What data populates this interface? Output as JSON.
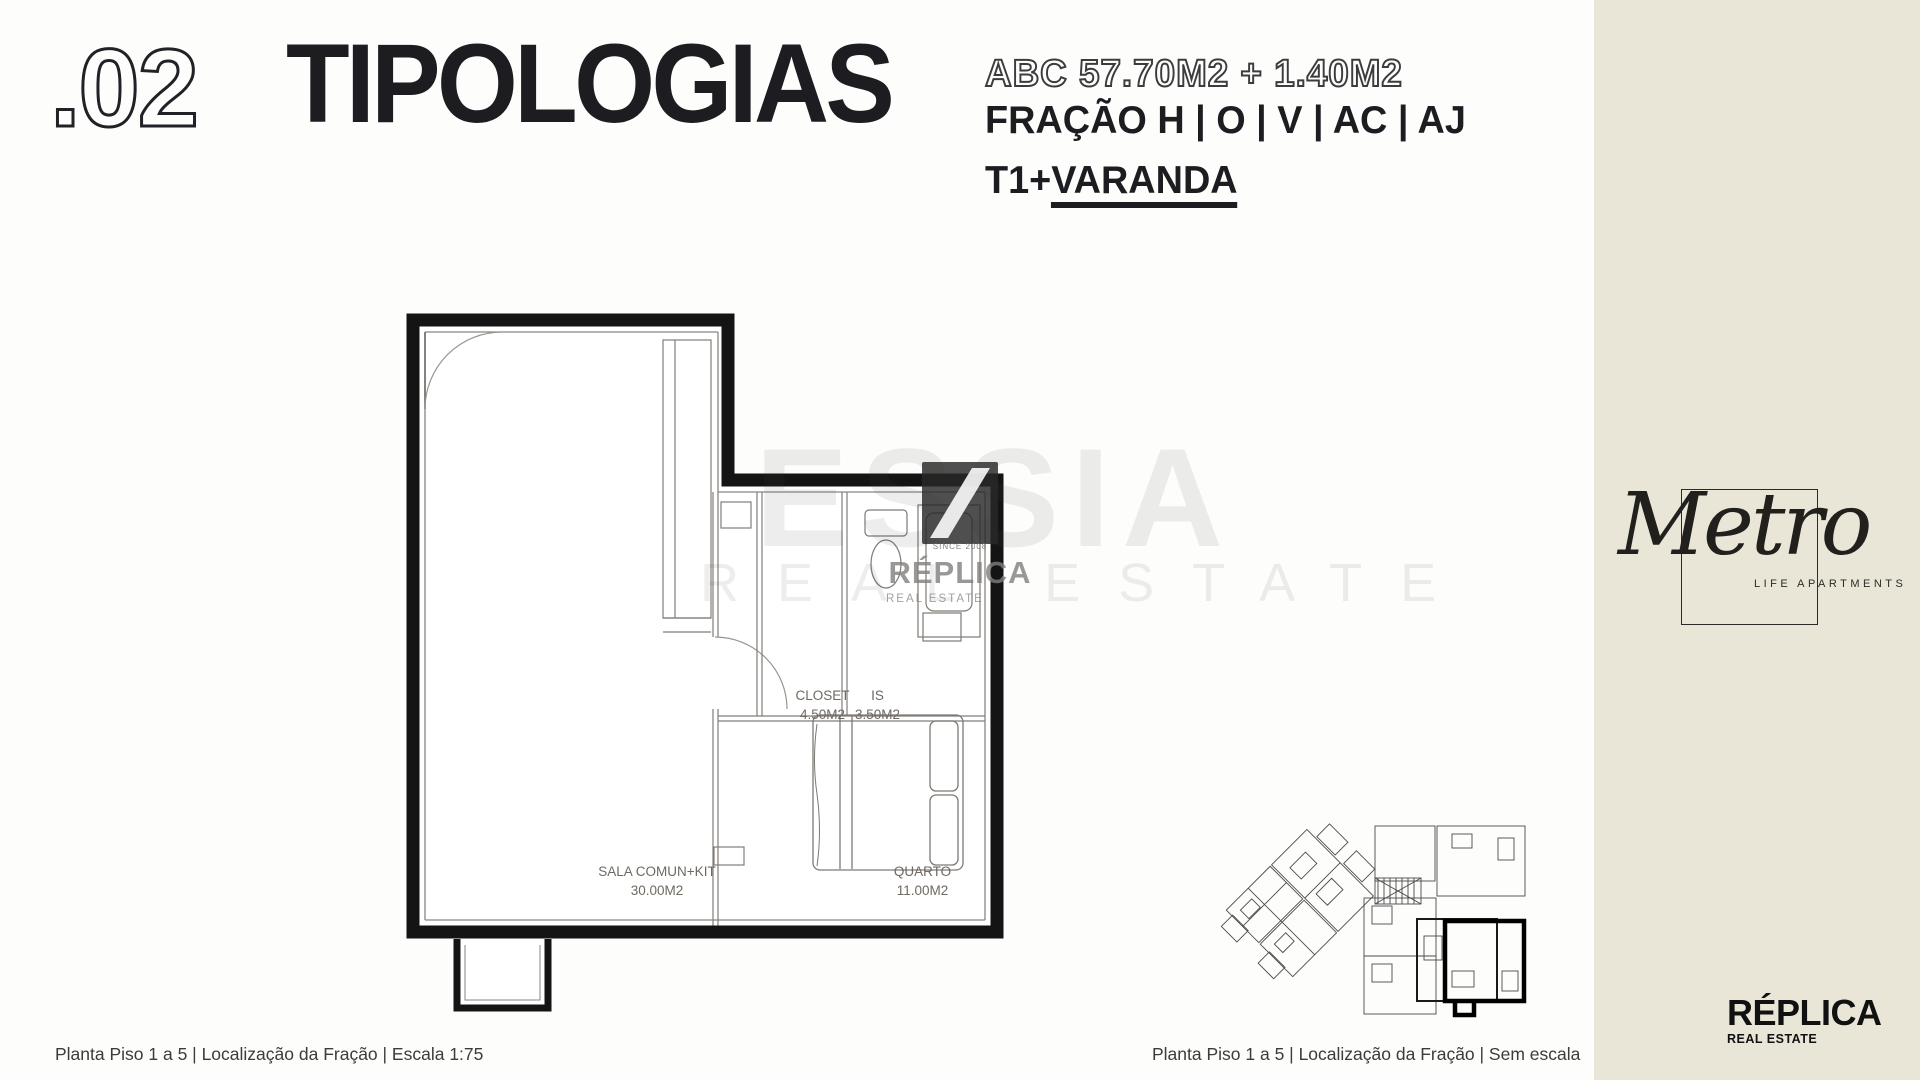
{
  "slide": {
    "header": {
      "index": ".02",
      "title": "TIPOLOGIAS",
      "area": "ABC 57.70M2 + 1.40M2",
      "fraction": "FRAÇÃO H | O | V | AC | AJ",
      "type_prefix": "T1+",
      "type_suffix": "VARANDA"
    },
    "floor_plan": {
      "caption": "Planta Piso 1 a 5 | Localização da Fração | Escala 1:75",
      "rooms": [
        {
          "name": "SALA COMUN+KIT",
          "area": "30.00M2"
        },
        {
          "name": "CLOSET",
          "area": "4.50M2"
        },
        {
          "name": "IS",
          "area": "3.50M2"
        },
        {
          "name": "QUARTO",
          "area": "11.00M2"
        }
      ]
    },
    "site_plan": {
      "caption": "Planta Piso 1 a 5 | Localização da Fração | Sem escala"
    },
    "watermark": {
      "since": "SINCE 2008",
      "brand": "RÉPLICA",
      "sub": "REAL ESTATE",
      "faint_brand": "ESSIA",
      "faint_sub": "REAL ESTATE"
    },
    "sidebar": {
      "brand_script": "Metro",
      "brand_sub": "LIFE APARTMENTS"
    },
    "footer_brand": {
      "name": "RÉPLICA",
      "sub": "REAL ESTATE"
    },
    "colors": {
      "sidebar_bg": "#e9e6d7",
      "ink": "#1d1c21",
      "plan_wall": "#141414",
      "label": "#6e6961"
    }
  }
}
